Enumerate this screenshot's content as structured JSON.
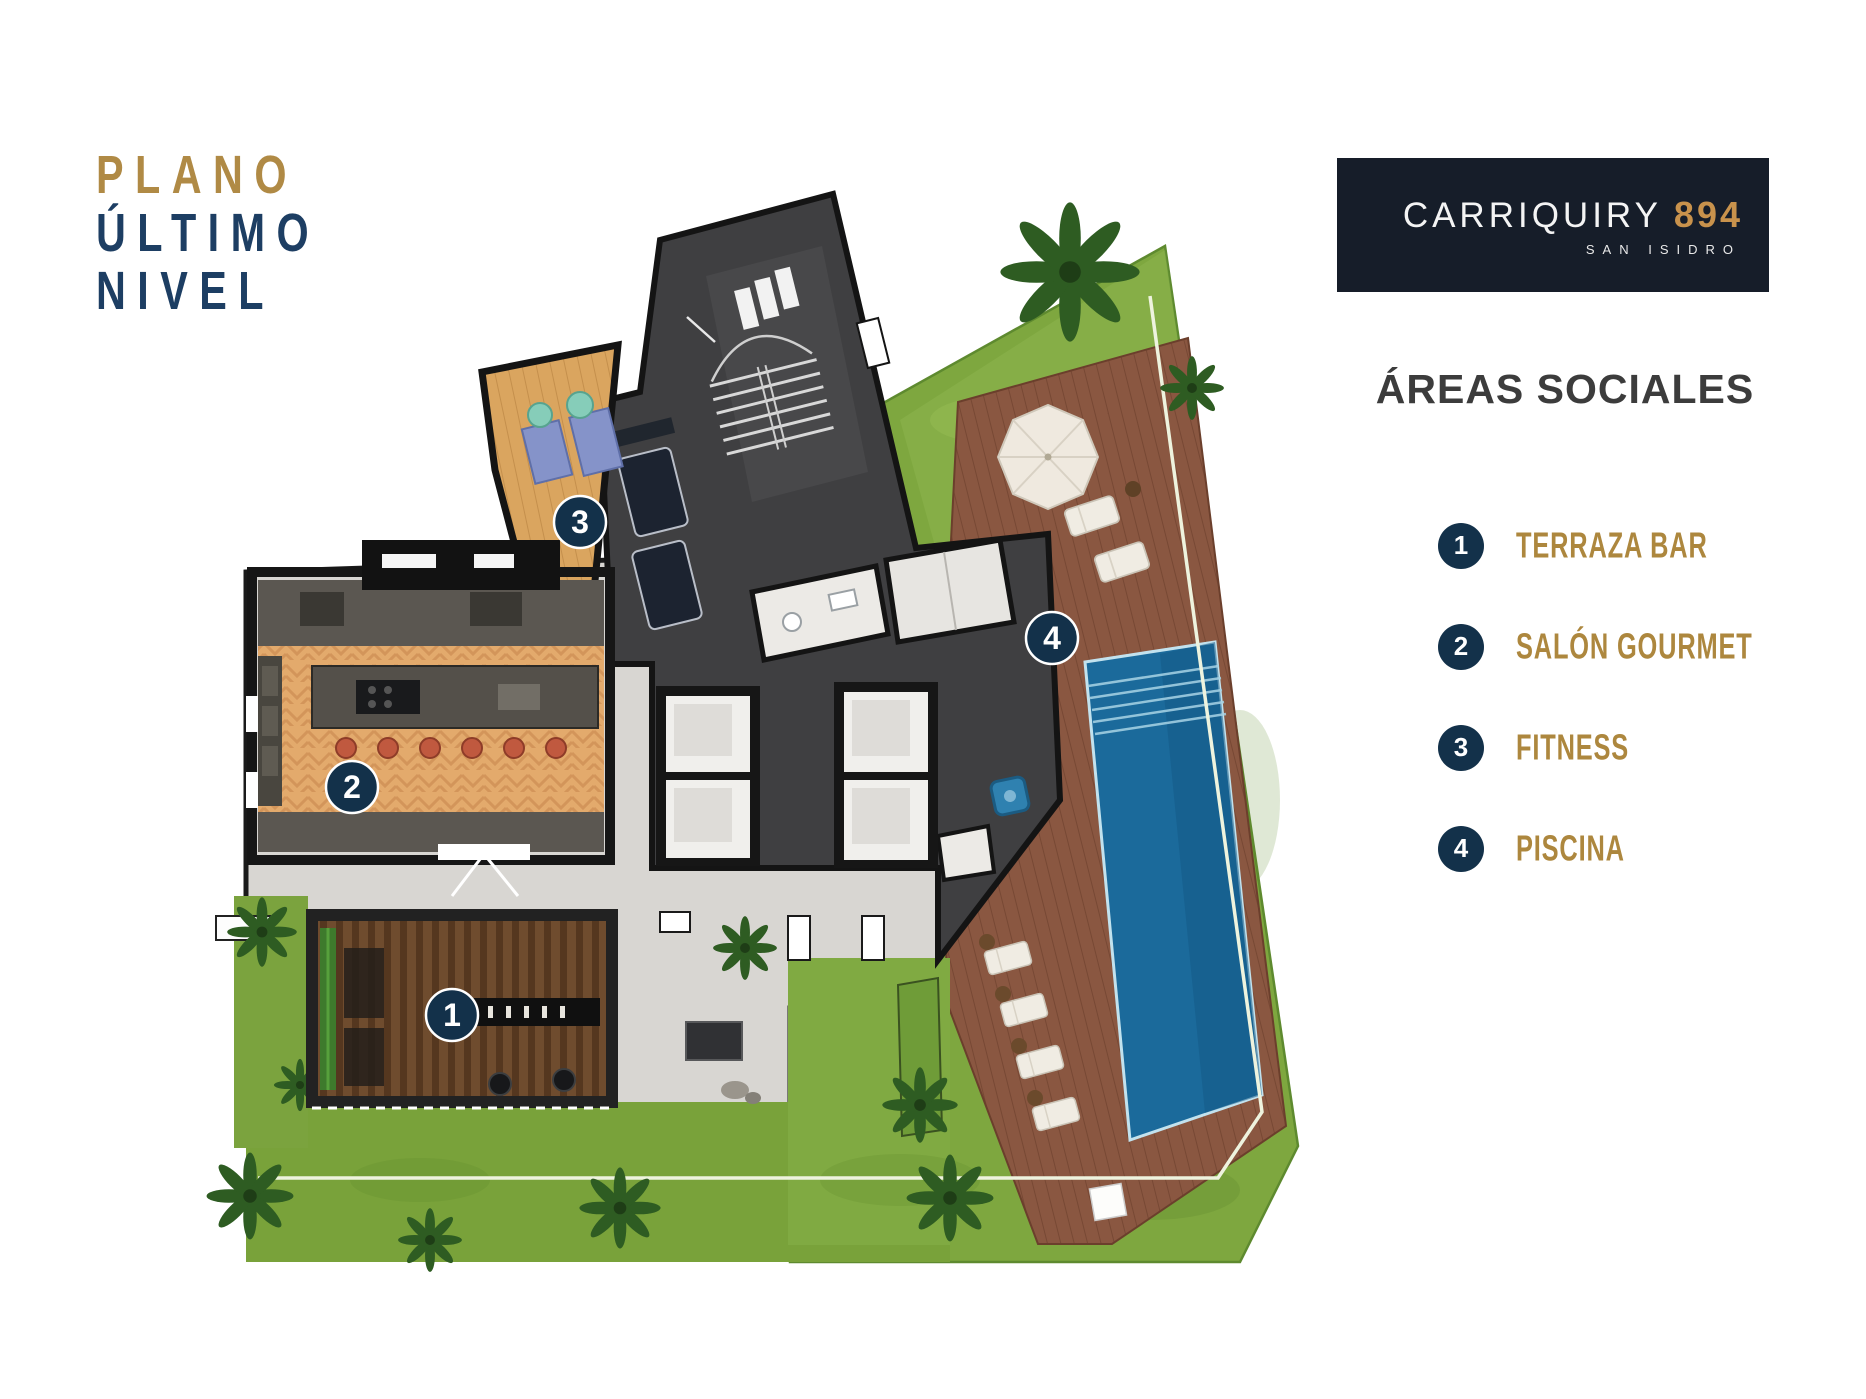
{
  "title": {
    "line1": "PLANO",
    "line2": "ÚLTIMO",
    "line3": "NIVEL"
  },
  "logo": {
    "brand": "CARRIQUIRY",
    "number": "894",
    "location": "SAN ISIDRO"
  },
  "legend": {
    "heading": "ÁREAS SOCIALES",
    "items": [
      {
        "number": "1",
        "label": "TERRAZA BAR"
      },
      {
        "number": "2",
        "label": "SALÓN GOURMET"
      },
      {
        "number": "3",
        "label": "FITNESS"
      },
      {
        "number": "4",
        "label": "PISCINA"
      }
    ]
  },
  "plan": {
    "markers": [
      {
        "number": "1",
        "area": "TERRAZA BAR"
      },
      {
        "number": "2",
        "area": "SALÓN GOURMET"
      },
      {
        "number": "3",
        "area": "FITNESS"
      },
      {
        "number": "4",
        "area": "PISCINA"
      }
    ]
  },
  "colors": {
    "gold": "#b08a45",
    "navy": "#1d3e63",
    "badge_navy": "#13314a",
    "logo_bg": "#161d29",
    "heading_gray": "#3c3c3c",
    "pool_blue": "#1b6a9b",
    "lawn_green": "#7ea73f",
    "deck_brown": "#8a5741",
    "wood_tan": "#daa55f",
    "core_gray": "#3f3f41"
  }
}
